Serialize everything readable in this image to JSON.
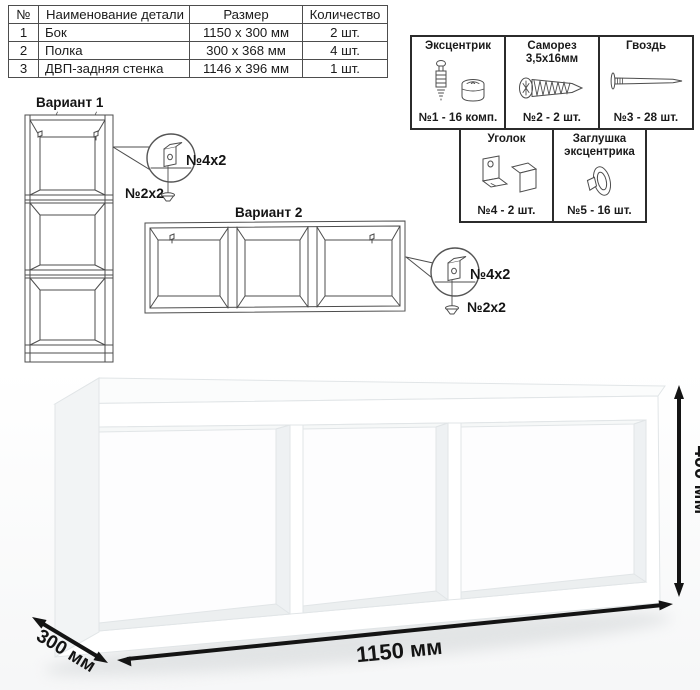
{
  "table": {
    "headers": [
      "№",
      "Наименование детали",
      "Размер",
      "Количество"
    ],
    "rows": [
      {
        "num": "1",
        "name": "Бок",
        "size": "1150 х 300 мм",
        "qty": "2 шт."
      },
      {
        "num": "2",
        "name": "Полка",
        "size": "300 х 368 мм",
        "qty": "4 шт."
      },
      {
        "num": "3",
        "name": "ДВП-задняя стенка",
        "size": "1146 х 396 мм",
        "qty": "1 шт."
      }
    ]
  },
  "hardware": {
    "cells": [
      {
        "title": "Эксцентрик",
        "count": "№1 - 16 комп.",
        "icon": "cam-lock-icon"
      },
      {
        "title": "Саморез 3,5х16мм",
        "count": "№2 - 2 шт.",
        "icon": "screw-icon"
      },
      {
        "title": "Гвоздь",
        "count": "№3 - 28 шт.",
        "icon": "nail-icon"
      },
      {
        "title": "Уголок",
        "count": "№4 - 2 шт.",
        "icon": "corner-bracket-icon"
      },
      {
        "title": "Заглушка эксцентрика",
        "count": "№5 - 16 шт.",
        "icon": "cam-cap-icon"
      }
    ]
  },
  "variant1": {
    "title": "Вариант 1",
    "bracket_label": "№4х2",
    "screw_label": "№2х2"
  },
  "variant2": {
    "title": "Вариант 2",
    "bracket_label": "№4х2",
    "screw_label": "№2х2"
  },
  "dimensions": {
    "width": "1150 мм",
    "height": "400 мм",
    "depth": "300 мм"
  },
  "colors": {
    "line_art": "#4d4d4d",
    "border": "#2b2b2b",
    "dimension": "#141414"
  }
}
